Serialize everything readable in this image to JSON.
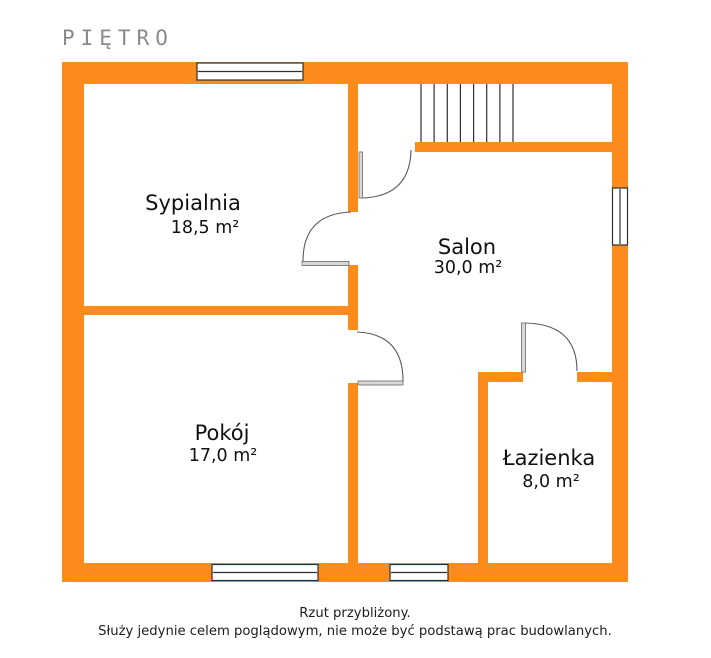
{
  "page": {
    "title": "PIĘTRO"
  },
  "plan": {
    "wall_color": "#fb8b1a",
    "line_color": "#2f2f2f",
    "door_color": "#5a5a5a",
    "rooms": [
      {
        "name": "Sypialnia",
        "area": "18,5 m²"
      },
      {
        "name": "Salon",
        "area": "30,0 m²"
      },
      {
        "name": "Pokój",
        "area": "17,0 m²"
      },
      {
        "name": "Łazienka",
        "area": "8,0 m²"
      }
    ]
  },
  "footer": {
    "line1": "Rzut przybliżony.",
    "line2": "Służy jedynie celem poglądowym, nie może być podstawą prac budowlanych."
  }
}
